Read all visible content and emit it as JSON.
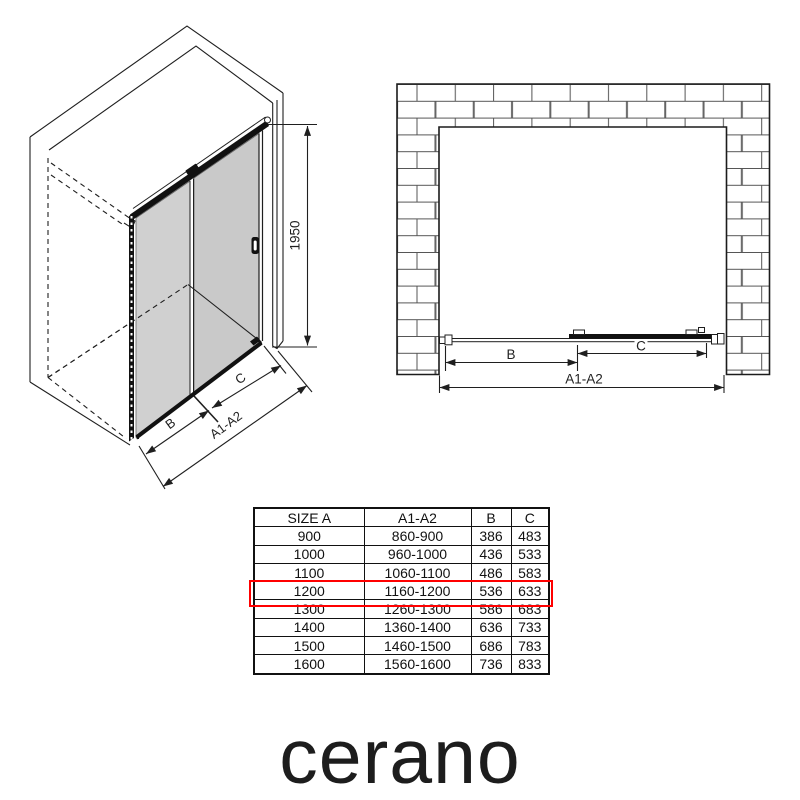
{
  "iso_view": {
    "dim_labels": {
      "height": "1950",
      "b": "B",
      "c": "C",
      "a": "A1-A2"
    }
  },
  "front_view": {
    "dim_labels": {
      "b": "B",
      "c": "C",
      "a": "A1-A2"
    }
  },
  "size_table": {
    "headers": [
      "SIZE A",
      "A1-A2",
      "B",
      "C"
    ],
    "rows": [
      [
        "900",
        "860-900",
        "386",
        "483"
      ],
      [
        "1000",
        "960-1000",
        "436",
        "533"
      ],
      [
        "1100",
        "1060-1100",
        "486",
        "583"
      ],
      [
        "1200",
        "1160-1200",
        "536",
        "633"
      ],
      [
        "1300",
        "1260-1300",
        "586",
        "683"
      ],
      [
        "1400",
        "1360-1400",
        "636",
        "733"
      ],
      [
        "1500",
        "1460-1500",
        "686",
        "783"
      ],
      [
        "1600",
        "1560-1600",
        "736",
        "833"
      ]
    ],
    "highlighted_row_value": "1200",
    "highlight_color": "#ff0000"
  },
  "brand": {
    "logo_text": "cerano"
  },
  "colors": {
    "line": "#1f1f1f",
    "glass_left": "#d0d0d0",
    "glass_right": "#c9c9c9",
    "brick_line": "#555555",
    "background": "#ffffff",
    "highlight": "#ff0000"
  }
}
